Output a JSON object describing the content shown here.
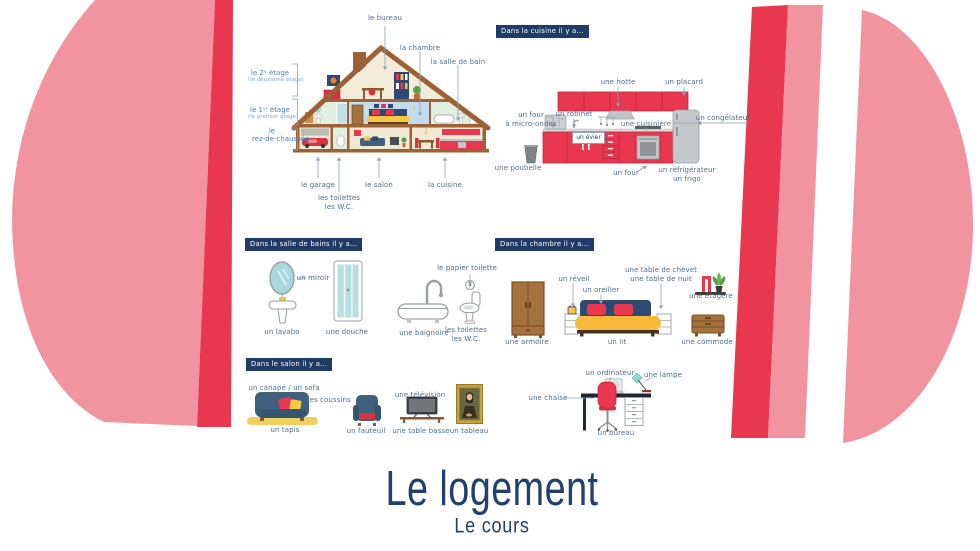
{
  "poster": {
    "title": "Le logement",
    "subtitle": "Le cours"
  },
  "colors": {
    "accent_red": "#e8374e",
    "accent_pink": "#f2949f",
    "navy": "#1f3b66",
    "label_blue": "#4c6d8e",
    "floor_label_blue": "#4d7dc4"
  },
  "house": {
    "top_labels": [
      {
        "label": "le bureau"
      },
      {
        "label": "la chambre"
      },
      {
        "label": "la salle de bain"
      }
    ],
    "floor_labels": [
      {
        "line1": "le 2ᵉ étage",
        "line2": "(le deuxième étage)"
      },
      {
        "line1": "le 1ᵉʳ étage",
        "line2": "(le premier étage)"
      },
      {
        "line1": "le",
        "line2": "rez-de-chaussée"
      }
    ],
    "bottom_labels": [
      {
        "label": "le garage"
      },
      {
        "label": "les toilettes\nles W.C."
      },
      {
        "label": "le salon"
      },
      {
        "label": "la cuisine"
      }
    ]
  },
  "kitchen": {
    "header": "Dans la cuisine il y a...",
    "labels": {
      "hotte": "une hotte",
      "placard": "un placard",
      "micro_ondes": "un four\nà micro-ondes",
      "robinet": "un robinet",
      "evier": "un évier",
      "cuisiniere": "une cuisinière",
      "congelateur": "un congélateur",
      "poubelle": "une poubelle",
      "four": "un four",
      "refrigerateur": "un réfrigérateur\nun frigo"
    }
  },
  "bathroom": {
    "header": "Dans la salle de bains il y a...",
    "labels": {
      "miroir": "un miroir",
      "lavabo": "un lavabo",
      "douche": "une douche",
      "baignoire": "une baignoire",
      "papier": "le papier toilette",
      "toilettes": "les toilettes\nles W.C."
    }
  },
  "bedroom": {
    "header": "Dans la chambre il y a...",
    "labels": {
      "reveil": "un réveil",
      "oreiller": "un oreiller",
      "chevet": "une table de chevet\nune table de nuit",
      "etagere": "une étagère",
      "armoire": "une armoire",
      "lit": "un lit",
      "commode": "une commode"
    }
  },
  "living_room": {
    "header": "Dans le salon il y a...",
    "labels": {
      "canape": "un canapé / un sofa",
      "coussins": "des coussins",
      "tapis": "un tapis",
      "fauteuil": "un fauteuil",
      "television": "une télévision",
      "table_basse": "une table basse",
      "tableau": "un tableau",
      "chaise": "une chaise",
      "ordinateur": "un ordinateur",
      "lampe": "une lampe",
      "bureau": "un bureau"
    }
  }
}
